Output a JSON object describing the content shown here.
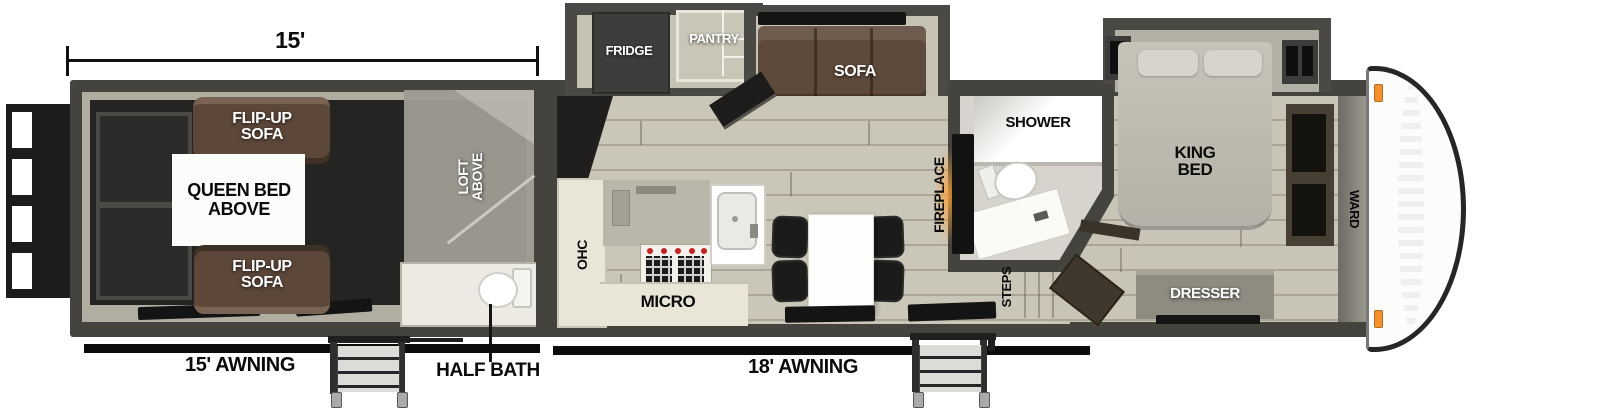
{
  "diagram": {
    "type": "rv-travel-trailer-floorplan",
    "garage_dimension": "15'",
    "awning_rear": "15' AWNING",
    "awning_main": "18' AWNING",
    "half_bath": "HALF BATH",
    "garage": {
      "flip_up_sofa_top": "FLIP-UP SOFA",
      "queen_bed_above": "QUEEN BED ABOVE",
      "flip_up_sofa_bottom": "FLIP-UP SOFA",
      "loft_above": "LOFT ABOVE"
    },
    "kitchen": {
      "fridge": "FRIDGE",
      "pantry": "PANTRY",
      "sofa": "SOFA",
      "ohc": "OHC",
      "micro": "MICRO",
      "fireplace": "FIREPLACE"
    },
    "bathroom": {
      "shower": "SHOWER",
      "steps": "STEPS"
    },
    "bedroom": {
      "king_bed": "KING BED",
      "ward": "WARD",
      "dresser": "DRESSER"
    },
    "colors": {
      "wall": "#44433e",
      "floor": "#cac6b8",
      "garage_floor": "#242422",
      "sofa_brown": "#5d4a3c",
      "cabinet_cream": "#e9e6d7",
      "marker_orange": "#f5922e"
    }
  }
}
